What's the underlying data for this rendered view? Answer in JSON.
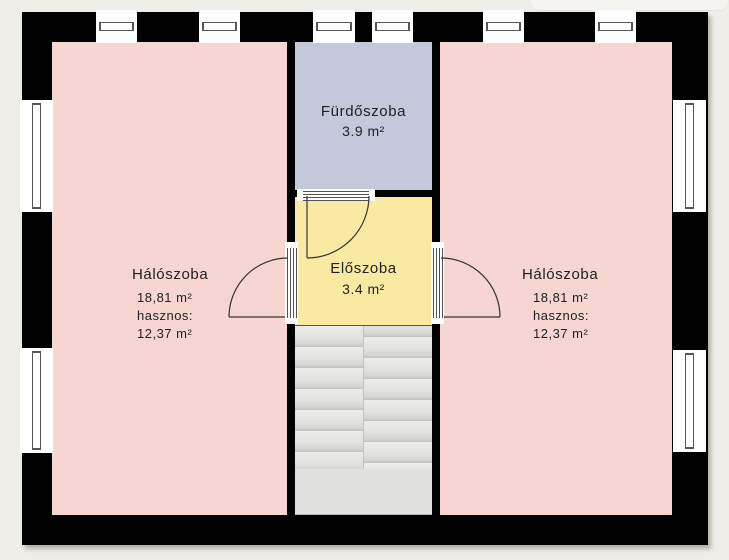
{
  "plan": {
    "type": "floor-plan",
    "language": "hu"
  },
  "rooms": {
    "bedroom_left": {
      "name": "Hálószoba",
      "area": "18,81 m²",
      "usable_label": "hasznos:",
      "usable_area": "12,37 m²",
      "fill": "#f7d6d2"
    },
    "bathroom": {
      "name": "Fürdőszoba",
      "area": "3.9 m²",
      "fill": "#c5c7db"
    },
    "hall": {
      "name": "Előszoba",
      "area": "3.4 m²",
      "fill": "#fae9a2"
    },
    "bedroom_right": {
      "name": "Hálószoba",
      "area": "18,81 m²",
      "usable_label": "hasznos:",
      "usable_area": "12,37 m²",
      "fill": "#f7d6d2"
    }
  },
  "stairs": {
    "fill": "#e1e1e0",
    "step_edge_color": "#c6c6c4"
  },
  "palette": {
    "background": "#f0eee9",
    "wall": "#000000",
    "window": "#ffffff",
    "door_line": "#333333",
    "text": "#1f1f1f"
  },
  "windows": {
    "top_count": 6,
    "left_count": 2,
    "right_count": 2
  },
  "doors": [
    "bathroom-to-hall",
    "hall-to-bedroom-left",
    "hall-to-bedroom-right"
  ]
}
